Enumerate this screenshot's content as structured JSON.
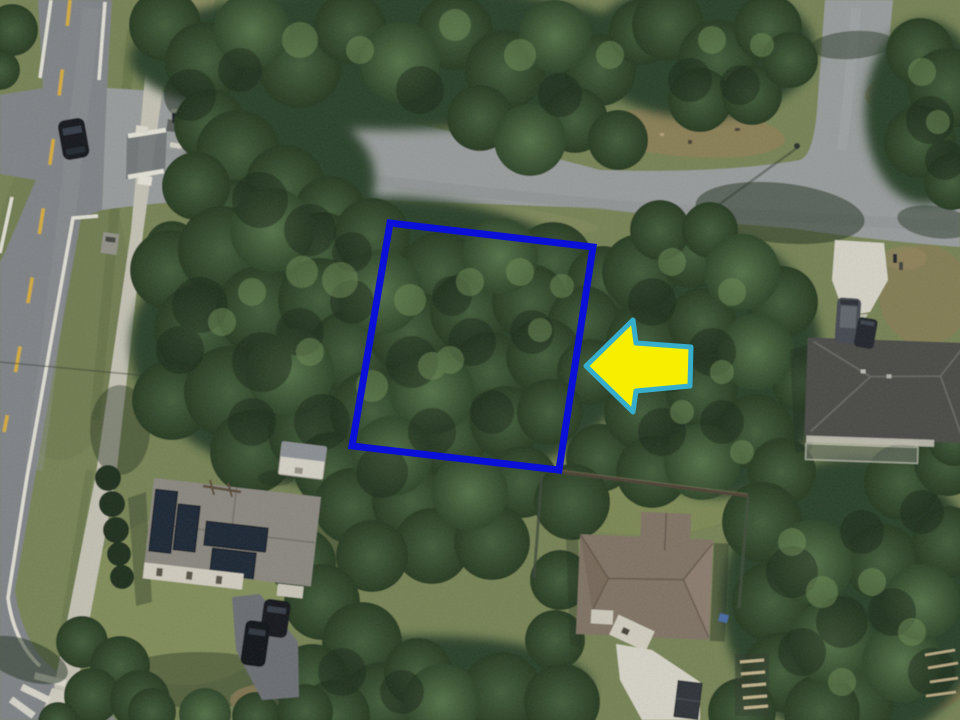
{
  "annotations": {
    "parcel_outline": {
      "points": "390,223 593,247 559,470 352,446",
      "stroke": "#0a10d8",
      "stroke_width": 7,
      "fill": "none"
    },
    "direction_arrow": {
      "points": "586,366 633,320 636,343 691,347 690,386 636,391 633,412",
      "fill": "#f8ef00",
      "stroke": "#36aecb",
      "stroke_width": 5
    }
  },
  "scene": {
    "ground": "#7a8758",
    "road_main": "#84888c",
    "road_side": "#9da1a1",
    "sidewalk": "#cbc9ba",
    "lane_yellow": "#ddb23e",
    "edge_white": "#e9e7dc",
    "canopy": "#2c4229",
    "roof_house_left": "#8f8c84",
    "roof_house_center": "#847768",
    "roof_house_right": "#4d4d4a",
    "solar_panel": "#1c2836",
    "driveway_concrete": "#dddbce",
    "driveway_asphalt": "#6e7176",
    "vehicle_dark": "#15181d"
  }
}
